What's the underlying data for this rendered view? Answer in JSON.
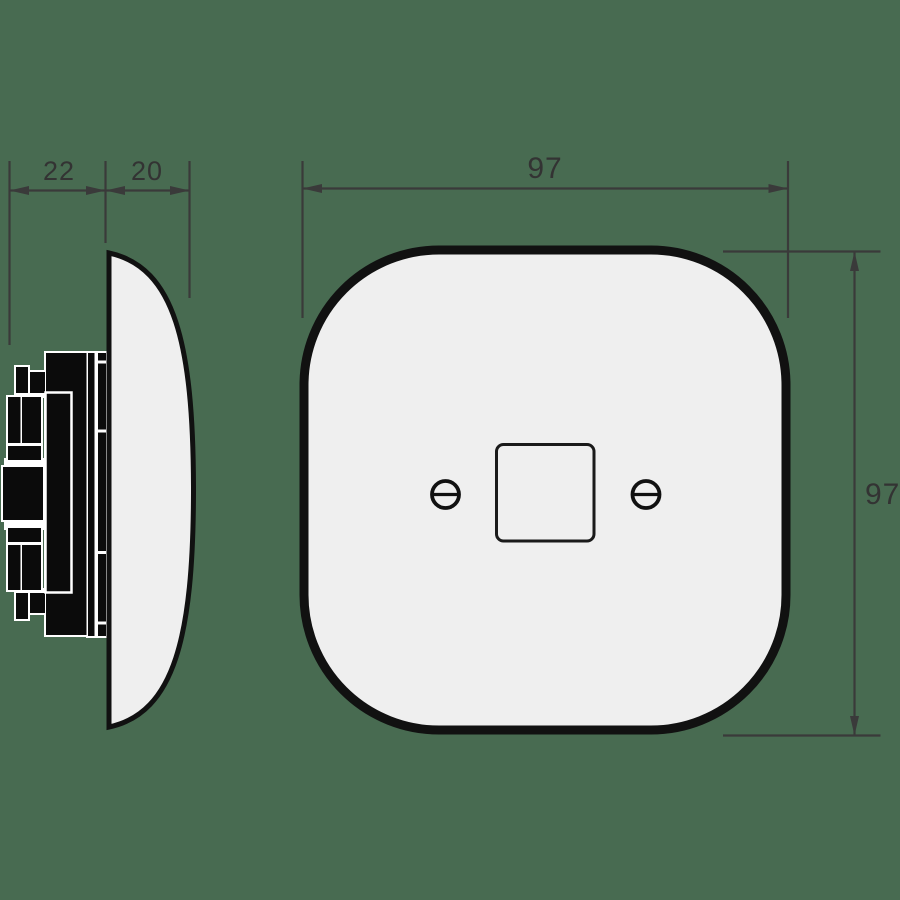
{
  "drawing": {
    "side_view": {
      "dim_depth_mechanism": "22",
      "dim_depth_cover": "20"
    },
    "front_view": {
      "dim_width": "97",
      "dim_height": "97"
    }
  },
  "colors": {
    "background": "#486b51",
    "plate_fill": "#efefef",
    "outline": "#111111",
    "mechanism_fill": "#0b0b0b",
    "seam_white": "#ffffff",
    "dimension_lines": "#3a3a3a",
    "dimension_text": "#333333"
  }
}
